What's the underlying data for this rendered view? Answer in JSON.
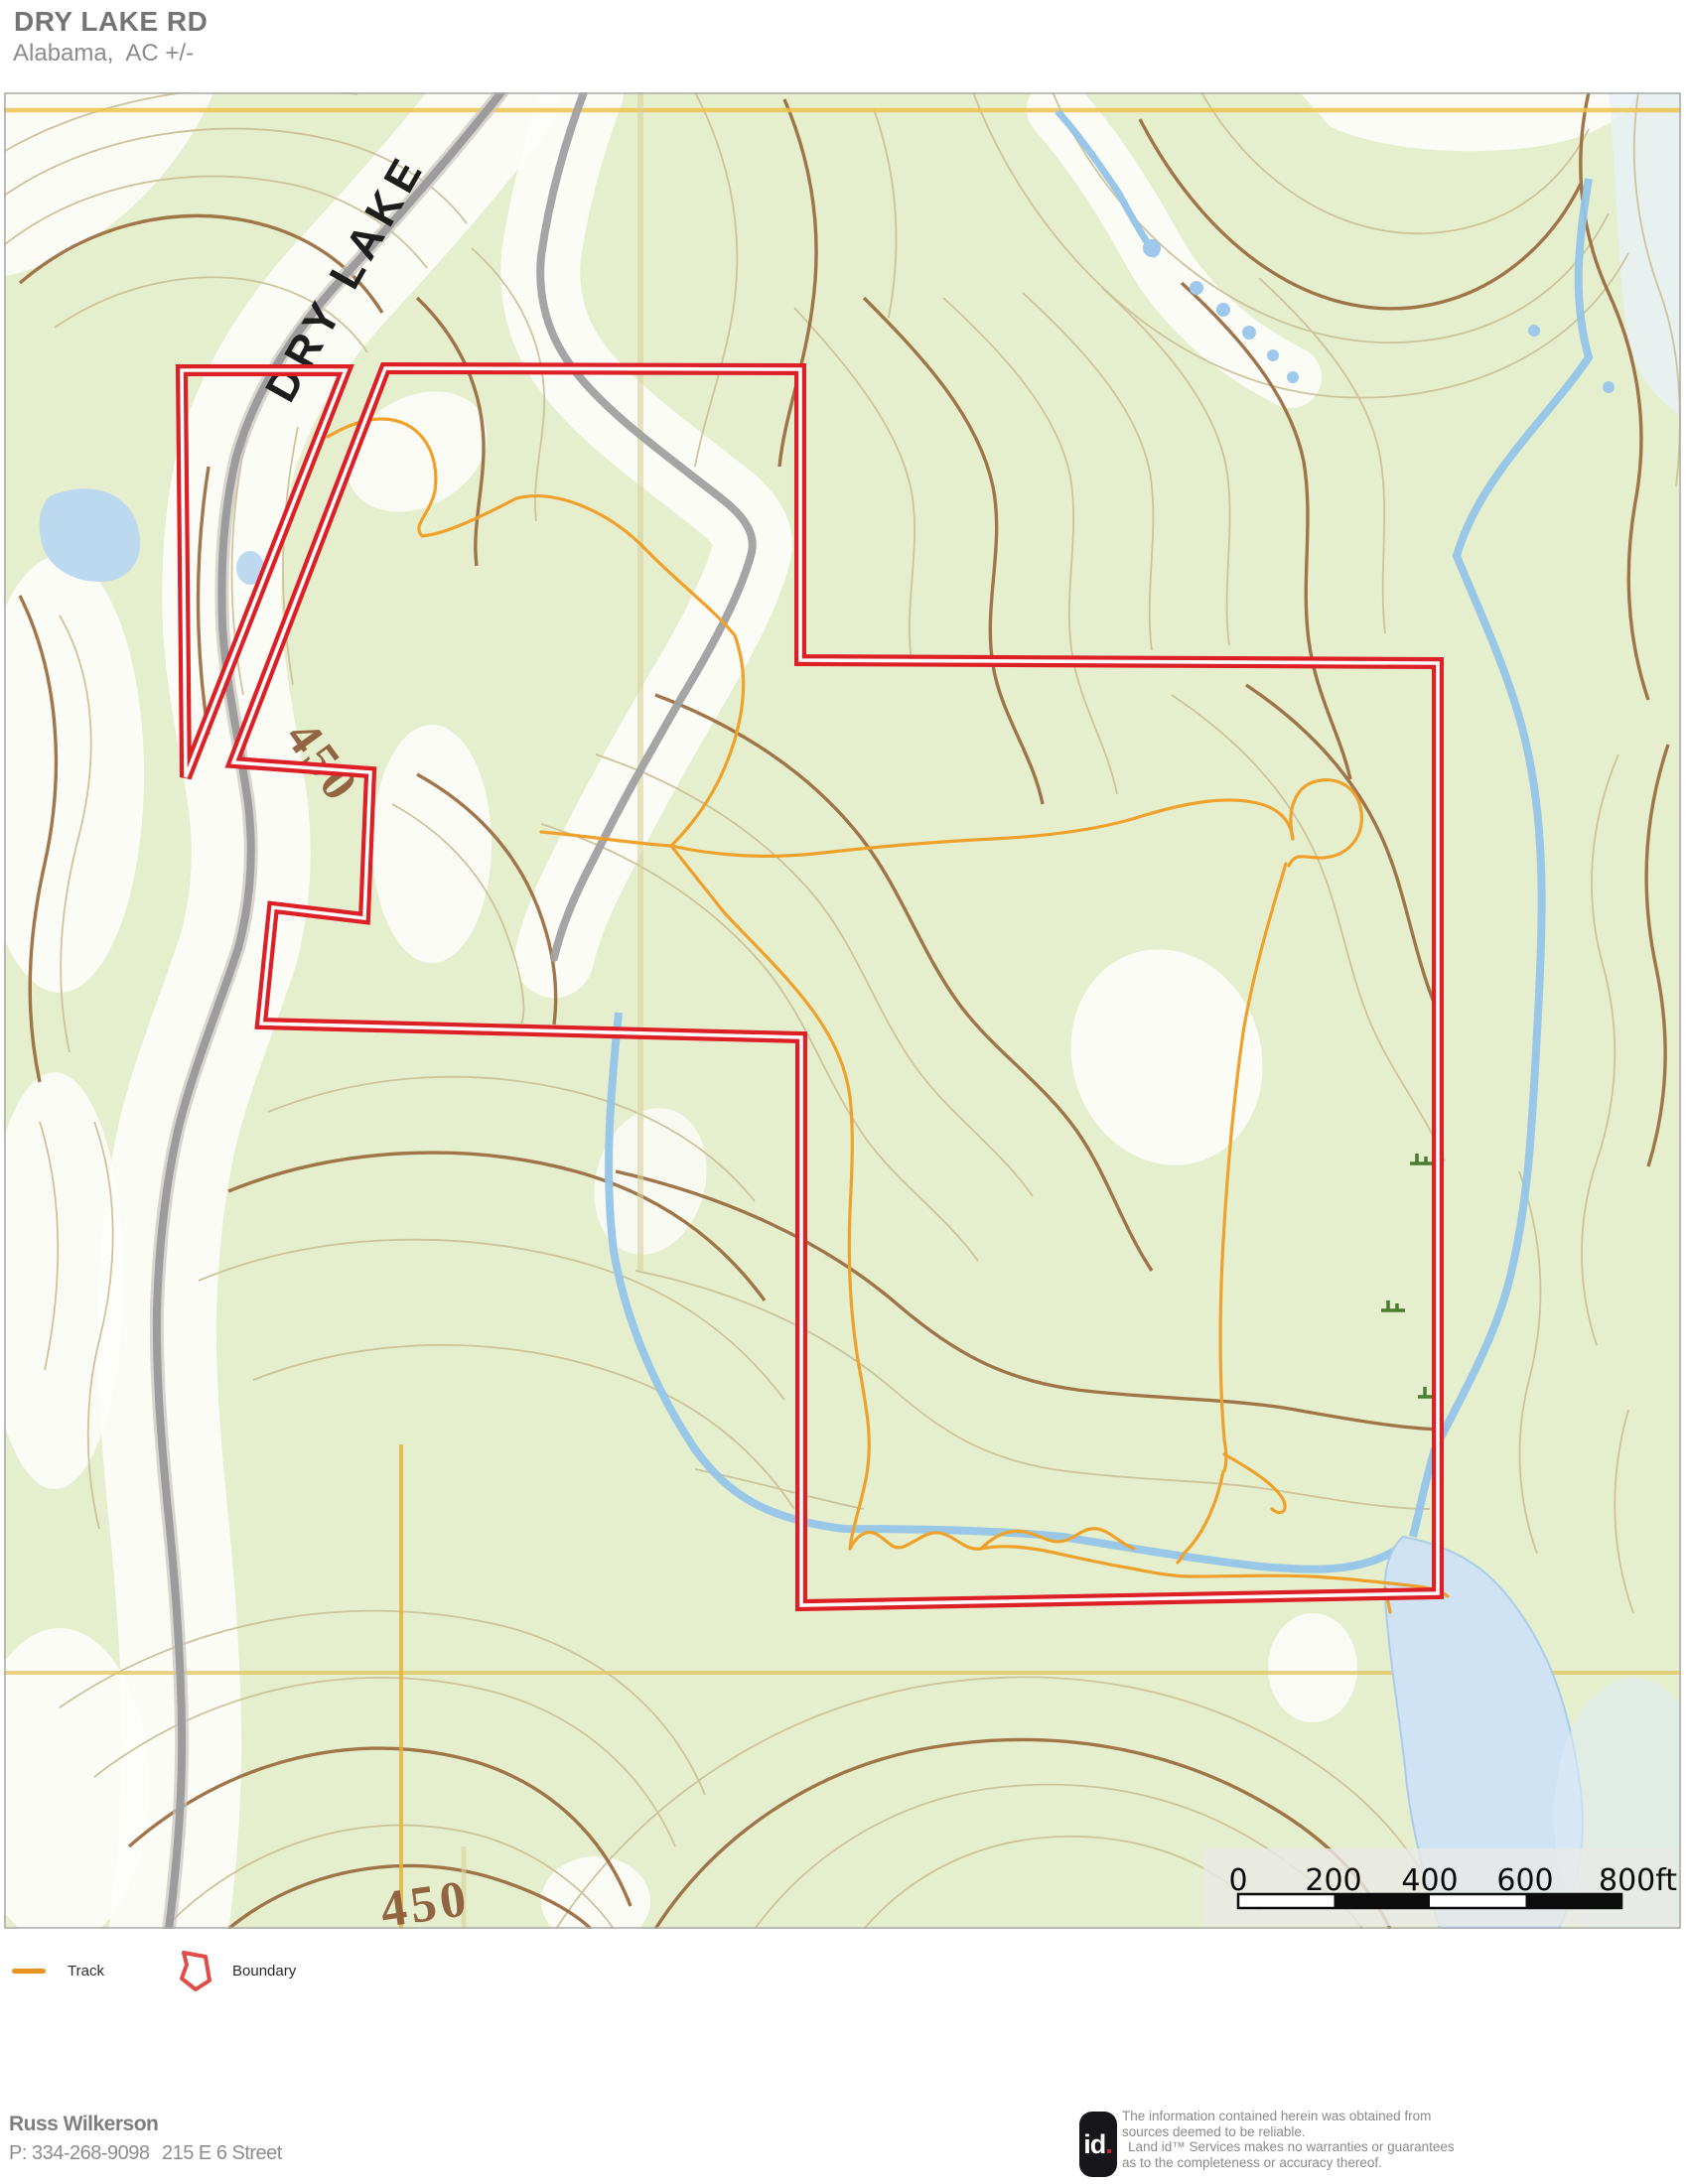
{
  "header": {
    "title": "DRY LAKE RD",
    "subtitle": "Alabama,  AC +/-"
  },
  "map": {
    "road_label": "DRY LAKE",
    "contour_label_upper": "450",
    "contour_label_lower": "450",
    "scale": {
      "ticks": [
        "0",
        "200",
        "400",
        "600",
        "800ft"
      ]
    },
    "colors": {
      "boundary": "#dd1f26",
      "track": "#efa12b",
      "road": "#9c9c9c",
      "water": "#93c4e9",
      "pond": "#cfe3f4",
      "contour_index": "#9a6a3d",
      "contour_intermediate": "#cbc199",
      "vegetation": "#e6efcd",
      "grid": "#e9c050"
    }
  },
  "legend": {
    "track_label": "Track",
    "boundary_label": "Boundary"
  },
  "footer": {
    "name": "Russ Wilkerson",
    "phone": "P: 334-268-9098",
    "address": "215 E 6 Street",
    "logo_text": "id",
    "logo_dot": ".",
    "disclaimer_lines": [
      "The information contained herein was obtained from",
      "sources deemed to be reliable.",
      "Land id™ Services makes no warranties or guarantees",
      "as to the completeness or accuracy thereof."
    ]
  }
}
